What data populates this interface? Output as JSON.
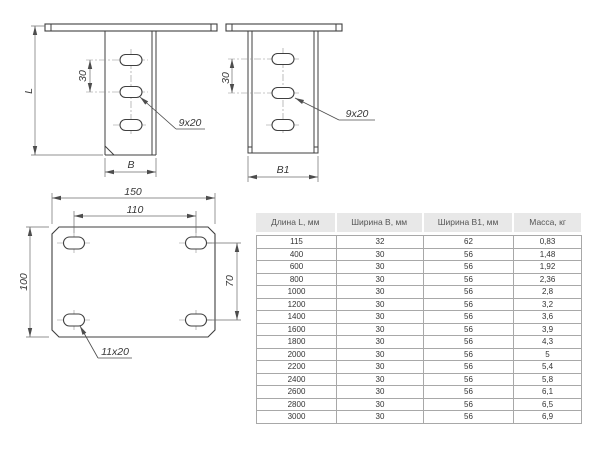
{
  "drawings": {
    "side_view": {
      "length_label": "L",
      "slot_spacing_label": "30",
      "width_label": "B",
      "slot_callout": "9x20"
    },
    "front_view": {
      "slot_spacing_label": "30",
      "width_label": "B1",
      "slot_callout": "9x20"
    },
    "plan_view": {
      "overall_width_label": "150",
      "hole_spacing_x_label": "110",
      "overall_height_label": "100",
      "hole_spacing_y_label": "70",
      "slot_callout": "11x20"
    }
  },
  "table": {
    "headers": [
      "Длина L, мм",
      "Ширина B, мм",
      "Ширина B1, мм",
      "Масса, кг"
    ],
    "rows": [
      [
        "115",
        "32",
        "62",
        "0,83"
      ],
      [
        "400",
        "30",
        "56",
        "1,48"
      ],
      [
        "600",
        "30",
        "56",
        "1,92"
      ],
      [
        "800",
        "30",
        "56",
        "2,36"
      ],
      [
        "1000",
        "30",
        "56",
        "2,8"
      ],
      [
        "1200",
        "30",
        "56",
        "3,2"
      ],
      [
        "1400",
        "30",
        "56",
        "3,6"
      ],
      [
        "1600",
        "30",
        "56",
        "3,9"
      ],
      [
        "1800",
        "30",
        "56",
        "4,3"
      ],
      [
        "2000",
        "30",
        "56",
        "5"
      ],
      [
        "2200",
        "30",
        "56",
        "5,4"
      ],
      [
        "2400",
        "30",
        "56",
        "5,8"
      ],
      [
        "2600",
        "30",
        "56",
        "6,1"
      ],
      [
        "2800",
        "30",
        "56",
        "6,5"
      ],
      [
        "3000",
        "30",
        "56",
        "6,9"
      ]
    ]
  },
  "colors": {
    "drawing_line": "#3f3f3f",
    "dimension_line": "#6b6b6b",
    "table_header_bg": "#e8e8e8",
    "table_inner_border": "#a8a8a8",
    "table_outer_border": "#6e6e6e",
    "text": "#383838"
  }
}
